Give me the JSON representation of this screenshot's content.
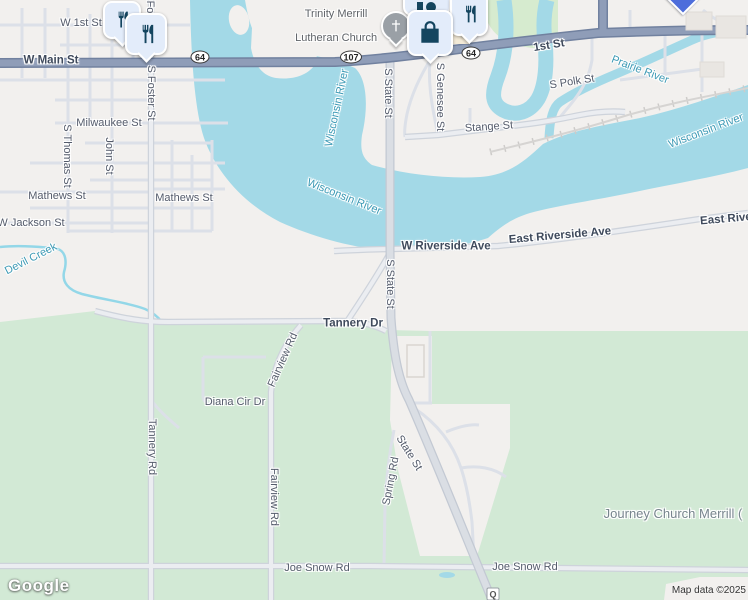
{
  "map": {
    "logo": "Google",
    "attribution": "Map data ©2025"
  },
  "colors": {
    "water": "#a3d9e7",
    "vegetation": "#d2e9d5",
    "urban_land": "#f2f0ee",
    "highway": "#8f9db8",
    "highway_casing": "#71819f",
    "major_road": "#dadee4",
    "pin_fill": "#e3ecfa",
    "pin_icon": "#14455f",
    "water_label": "#3d9ab5",
    "street_label": "#545b6b"
  },
  "shields": [
    {
      "label": "64"
    },
    {
      "label": "107"
    },
    {
      "label": "64"
    },
    {
      "label": "Q"
    }
  ],
  "pins": [
    {
      "icon": "restaurant-icon"
    },
    {
      "icon": "restaurant-icon"
    },
    {
      "icon": "church-icon"
    },
    {
      "icon": "store-icon"
    },
    {
      "icon": "shopping-bag-icon"
    },
    {
      "icon": "restaurant-icon"
    },
    {
      "icon": "poi-diamond-icon"
    }
  ],
  "labels": [
    {
      "name": "w-1st-st",
      "text": "W 1st St"
    },
    {
      "name": "w-main-st",
      "text": "W Main St"
    },
    {
      "name": "s-foster-st-partial",
      "text": "Fo"
    },
    {
      "name": "s-foster-st",
      "text": "S Foster St"
    },
    {
      "name": "milwaukee-st",
      "text": "Milwaukee St"
    },
    {
      "name": "s-thomas-st",
      "text": "S Thomas St"
    },
    {
      "name": "john-st",
      "text": "John St"
    },
    {
      "name": "mathews-st-west",
      "text": "Mathews St"
    },
    {
      "name": "mathews-st-east",
      "text": "Mathews St"
    },
    {
      "name": "w-jackson-st",
      "text": "W Jackson St"
    },
    {
      "name": "devil-creek",
      "text": "Devil Creek"
    },
    {
      "name": "trinity-church-line1",
      "text": "Trinity Merrill"
    },
    {
      "name": "trinity-church-line2",
      "text": "Lutheran Church"
    },
    {
      "name": "wisconsin-river-north",
      "text": "Wisconsin River"
    },
    {
      "name": "1st-st",
      "text": "1st St"
    },
    {
      "name": "s-state-st-north",
      "text": "S State St"
    },
    {
      "name": "s-genesee-st",
      "text": "S Genesee St"
    },
    {
      "name": "s-polk-st",
      "text": "S Polk St"
    },
    {
      "name": "prairie-river",
      "text": "Prairie River"
    },
    {
      "name": "stange-st",
      "text": "Stange St"
    },
    {
      "name": "wisconsin-river-northeast",
      "text": "Wisconsin River"
    },
    {
      "name": "wisconsin-river-center",
      "text": "Wisconsin River"
    },
    {
      "name": "east-riverside-ave",
      "text": "East Riverside Ave"
    },
    {
      "name": "east-riverside-ave-partial",
      "text": "East Riverside Ave"
    },
    {
      "name": "w-riverside-ave",
      "text": "W Riverside Ave"
    },
    {
      "name": "s-state-st-mid",
      "text": "S State St"
    },
    {
      "name": "tannery-dr",
      "text": "Tannery Dr"
    },
    {
      "name": "fairview-rd-upper",
      "text": "Fairview Rd"
    },
    {
      "name": "diana-cir-dr",
      "text": "Diana Cir Dr"
    },
    {
      "name": "tannery-rd",
      "text": "Tannery Rd"
    },
    {
      "name": "spring-rd",
      "text": "Spring Rd"
    },
    {
      "name": "state-st-diagonal",
      "text": "State St"
    },
    {
      "name": "fairview-rd-lower",
      "text": "Fairview Rd"
    },
    {
      "name": "journey-church-merrill",
      "text": "Journey Church Merrill ("
    },
    {
      "name": "joe-snow-rd-west",
      "text": "Joe Snow Rd"
    },
    {
      "name": "joe-snow-rd-east",
      "text": "Joe Snow Rd"
    }
  ]
}
